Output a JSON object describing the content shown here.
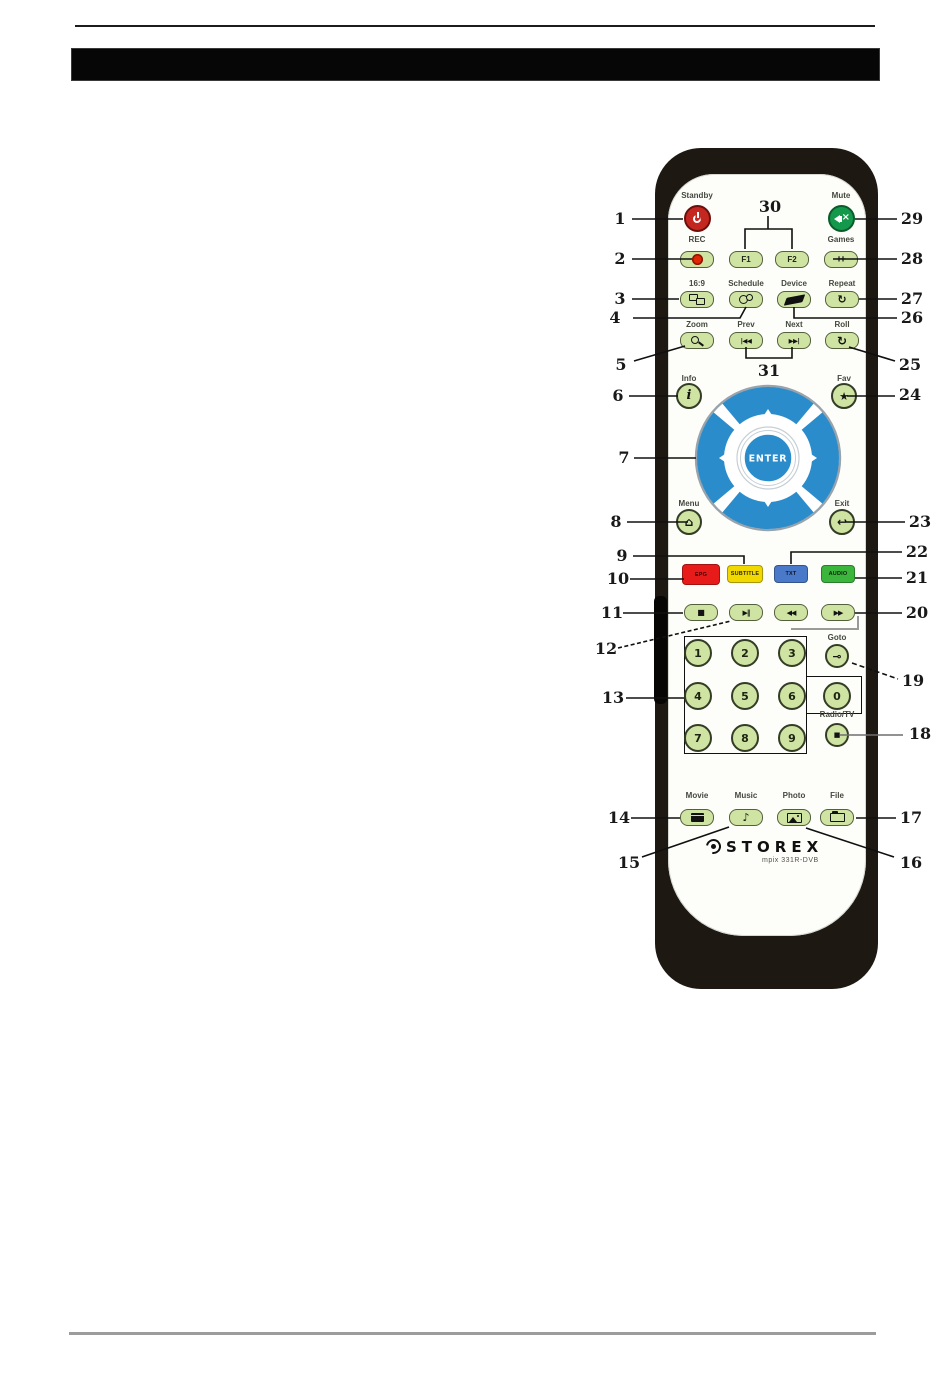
{
  "callouts": {
    "c1": "1",
    "c2": "2",
    "c3": "3",
    "c4": "4",
    "c5": "5",
    "c6": "6",
    "c7": "7",
    "c8": "8",
    "c9": "9",
    "c10": "10",
    "c11": "11",
    "c12": "12",
    "c13": "13",
    "c14": "14",
    "c15": "15",
    "c16": "16",
    "c17": "17",
    "c18": "18",
    "c19": "19",
    "c20": "20",
    "c21": "21",
    "c22": "22",
    "c23": "23",
    "c24": "24",
    "c25": "25",
    "c26": "26",
    "c27": "27",
    "c28": "28",
    "c29": "29",
    "c30": "30",
    "c31": "31"
  },
  "remote": {
    "brand": "STOREX",
    "model": "mpix 331R-DVB",
    "labels": {
      "standby": "Standby",
      "mute": "Mute",
      "rec": "REC",
      "games": "Games",
      "aspect": "16:9",
      "schedule": "Schedule",
      "device": "Device",
      "repeat": "Repeat",
      "zoom": "Zoom",
      "prev": "Prev",
      "next": "Next",
      "roll": "Roll",
      "info": "Info",
      "fav": "Fav",
      "menu": "Menu",
      "exit": "Exit",
      "goto": "Goto",
      "radio_tv": "Radio/TV",
      "movie": "Movie",
      "music": "Music",
      "photo": "Photo",
      "file": "File"
    },
    "buttons": {
      "f1": "F1",
      "f2": "F2",
      "enter": "ENTER",
      "epg": "EPG",
      "subtitle": "SUBTITLE",
      "txt": "TXT",
      "audio": "AUDIO"
    },
    "digits": [
      "1",
      "2",
      "3",
      "4",
      "5",
      "6",
      "7",
      "8",
      "9",
      "0"
    ],
    "glyphs": {
      "games": "++",
      "repeat": "↻",
      "roll": "↻",
      "prev": "|◀◀",
      "next": "▶▶|",
      "fav": "★",
      "menu": "⌂",
      "exit": "↩",
      "info": "i",
      "stop": "■",
      "play_pause": "▶‖",
      "rewind": "◀◀",
      "forward": "▶▶",
      "music": "♪",
      "goto": "⊸",
      "radio_tv": "■"
    },
    "colors": {
      "body_black": "#1d1812",
      "key_green": "#cfe3a2",
      "standby_red": "#c4271f",
      "mute_green": "#14984b",
      "dpad_blue": "#2b8ccc",
      "epg_red": "#e81b1b",
      "subtitle_yellow": "#f0d800",
      "txt_blue": "#4b79c9",
      "audio_green": "#3cb53c"
    }
  }
}
